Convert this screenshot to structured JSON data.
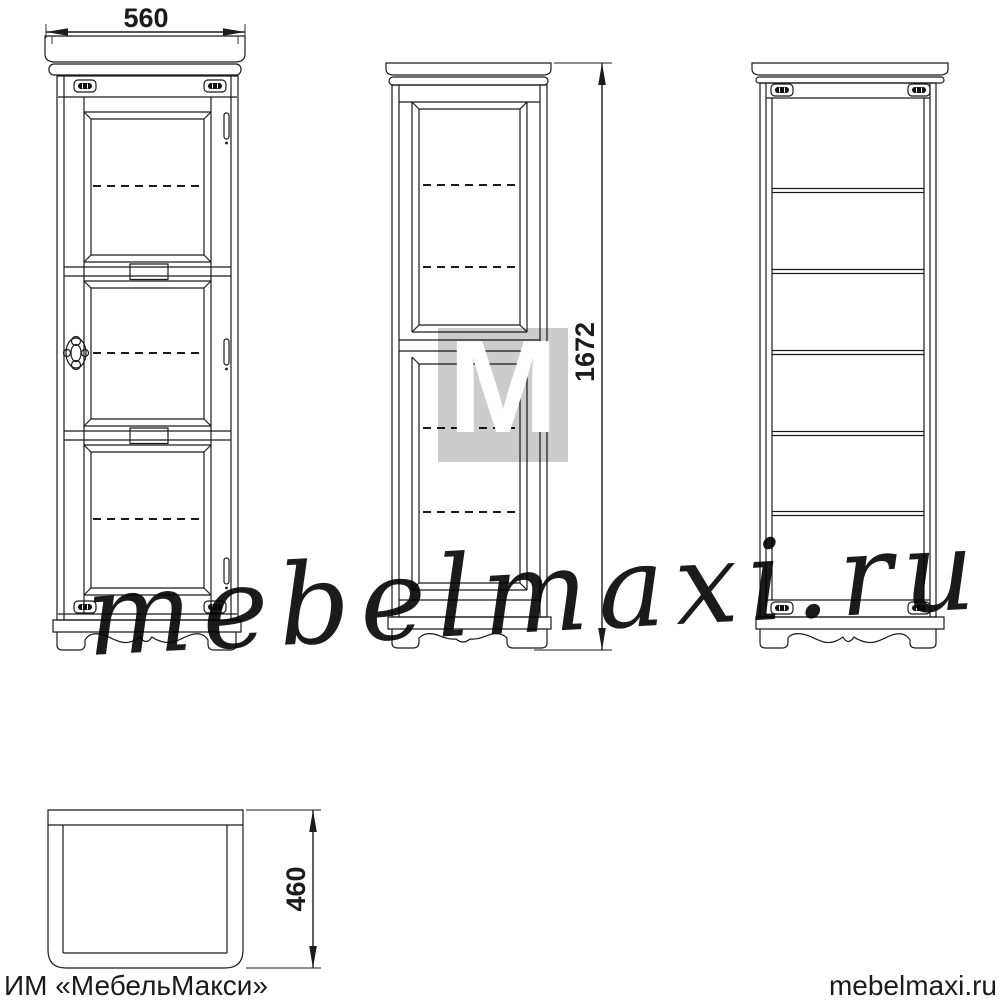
{
  "dimensions": {
    "width": "560",
    "height": "1672",
    "depth": "460"
  },
  "footer": {
    "left_text": "ИМ «МебельМакси»",
    "right_text": "mebelmaxi.ru"
  },
  "watermark": {
    "script_text": "mebelmaxi.ru",
    "logo_letter": "M"
  },
  "colors": {
    "line": "#1b1b1b",
    "background": "#ffffff",
    "glass_hatch": "#3d3d3d",
    "watermark_gray": "#b2b2b2",
    "logo_gray": "rgba(134,134,134,0.42)"
  },
  "icons": {
    "fastener": "cam-lock-fastener-icon",
    "hinge": "door-hinge-icon",
    "handle": "ornate-door-handle-icon"
  }
}
